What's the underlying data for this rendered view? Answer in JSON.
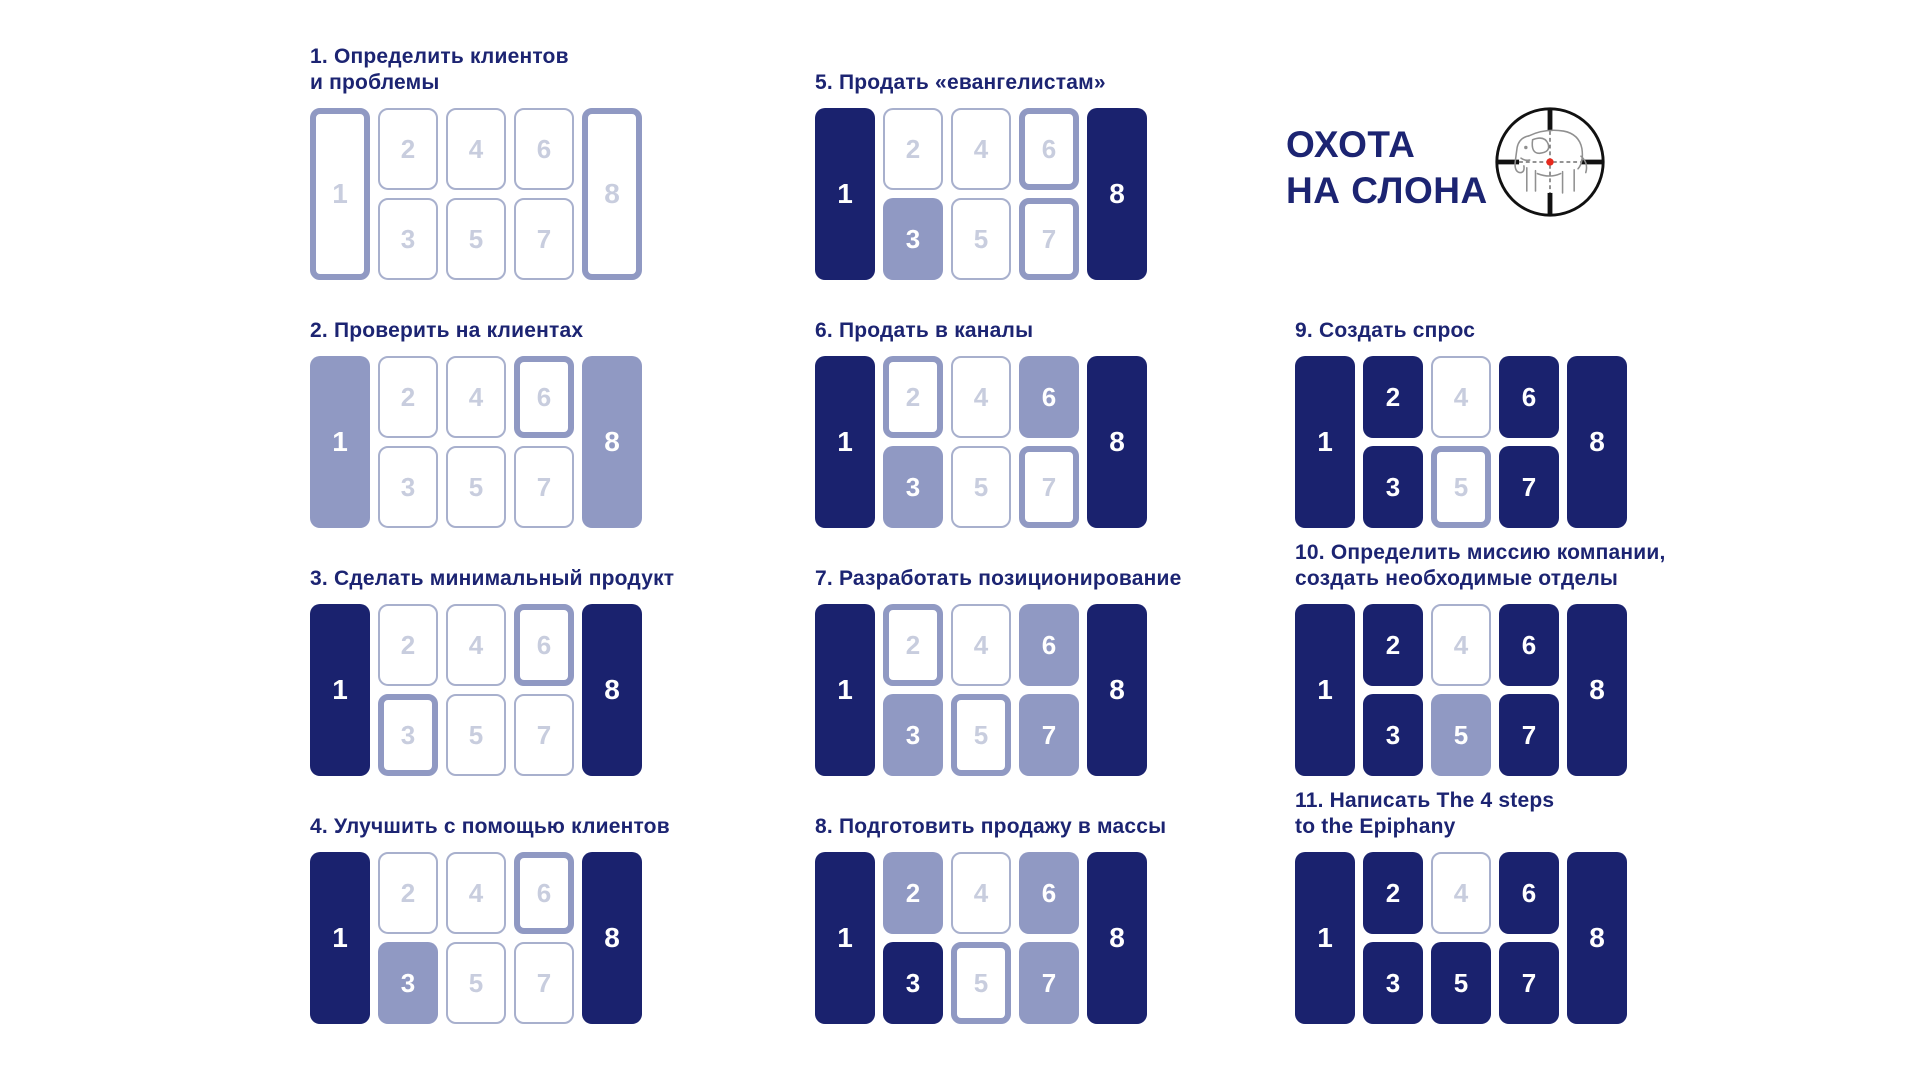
{
  "logo": {
    "title": "ОХОТА\nНА СЛОНА",
    "icon": "elephant-in-crosshair-icon"
  },
  "colors": {
    "dark_fill": "#1a226e",
    "light_fill": "#9099c3",
    "outline_border": "#a8b0cd",
    "thick_outline_border": "#9099c3",
    "muted_number": "#c8cdde",
    "title_text": "#1c2472",
    "crosshair_dot_red": "#e8291d",
    "elephant_gray": "#909090"
  },
  "steps": [
    {
      "title": "1. Определить клиентов\nи проблемы",
      "cells": {
        "c1": {
          "label": "1",
          "state": "outline-thick"
        },
        "c2": {
          "label": "2",
          "state": "outline"
        },
        "c3": {
          "label": "3",
          "state": "outline"
        },
        "c4": {
          "label": "4",
          "state": "outline"
        },
        "c5": {
          "label": "5",
          "state": "outline"
        },
        "c6": {
          "label": "6",
          "state": "outline"
        },
        "c7": {
          "label": "7",
          "state": "outline"
        },
        "c8": {
          "label": "8",
          "state": "outline-thick"
        }
      }
    },
    {
      "title": "2. Проверить на клиентах",
      "cells": {
        "c1": {
          "label": "1",
          "state": "light"
        },
        "c2": {
          "label": "2",
          "state": "outline"
        },
        "c3": {
          "label": "3",
          "state": "outline"
        },
        "c4": {
          "label": "4",
          "state": "outline"
        },
        "c5": {
          "label": "5",
          "state": "outline"
        },
        "c6": {
          "label": "6",
          "state": "outline-thick"
        },
        "c7": {
          "label": "7",
          "state": "outline"
        },
        "c8": {
          "label": "8",
          "state": "light"
        }
      }
    },
    {
      "title": "3. Сделать минимальный продукт",
      "cells": {
        "c1": {
          "label": "1",
          "state": "dark"
        },
        "c2": {
          "label": "2",
          "state": "outline"
        },
        "c3": {
          "label": "3",
          "state": "outline-thick"
        },
        "c4": {
          "label": "4",
          "state": "outline"
        },
        "c5": {
          "label": "5",
          "state": "outline"
        },
        "c6": {
          "label": "6",
          "state": "outline-thick"
        },
        "c7": {
          "label": "7",
          "state": "outline"
        },
        "c8": {
          "label": "8",
          "state": "dark"
        }
      }
    },
    {
      "title": "4. Улучшить с помощью клиентов",
      "cells": {
        "c1": {
          "label": "1",
          "state": "dark"
        },
        "c2": {
          "label": "2",
          "state": "outline"
        },
        "c3": {
          "label": "3",
          "state": "light"
        },
        "c4": {
          "label": "4",
          "state": "outline"
        },
        "c5": {
          "label": "5",
          "state": "outline"
        },
        "c6": {
          "label": "6",
          "state": "outline-thick"
        },
        "c7": {
          "label": "7",
          "state": "outline"
        },
        "c8": {
          "label": "8",
          "state": "dark"
        }
      }
    },
    {
      "title": "5. Продать «евангелистам»",
      "cells": {
        "c1": {
          "label": "1",
          "state": "dark"
        },
        "c2": {
          "label": "2",
          "state": "outline"
        },
        "c3": {
          "label": "3",
          "state": "light"
        },
        "c4": {
          "label": "4",
          "state": "outline"
        },
        "c5": {
          "label": "5",
          "state": "outline"
        },
        "c6": {
          "label": "6",
          "state": "outline-thick"
        },
        "c7": {
          "label": "7",
          "state": "outline-thick"
        },
        "c8": {
          "label": "8",
          "state": "dark"
        }
      }
    },
    {
      "title": "6. Продать в каналы",
      "cells": {
        "c1": {
          "label": "1",
          "state": "dark"
        },
        "c2": {
          "label": "2",
          "state": "outline-thick"
        },
        "c3": {
          "label": "3",
          "state": "light"
        },
        "c4": {
          "label": "4",
          "state": "outline"
        },
        "c5": {
          "label": "5",
          "state": "outline"
        },
        "c6": {
          "label": "6",
          "state": "light"
        },
        "c7": {
          "label": "7",
          "state": "outline-thick"
        },
        "c8": {
          "label": "8",
          "state": "dark"
        }
      }
    },
    {
      "title": "7. Разработать позиционирование",
      "cells": {
        "c1": {
          "label": "1",
          "state": "dark"
        },
        "c2": {
          "label": "2",
          "state": "outline-thick"
        },
        "c3": {
          "label": "3",
          "state": "light"
        },
        "c4": {
          "label": "4",
          "state": "outline"
        },
        "c5": {
          "label": "5",
          "state": "outline-thick"
        },
        "c6": {
          "label": "6",
          "state": "light"
        },
        "c7": {
          "label": "7",
          "state": "light"
        },
        "c8": {
          "label": "8",
          "state": "dark"
        }
      }
    },
    {
      "title": "8. Подготовить продажу в массы",
      "cells": {
        "c1": {
          "label": "1",
          "state": "dark"
        },
        "c2": {
          "label": "2",
          "state": "light"
        },
        "c3": {
          "label": "3",
          "state": "dark"
        },
        "c4": {
          "label": "4",
          "state": "outline"
        },
        "c5": {
          "label": "5",
          "state": "outline-thick"
        },
        "c6": {
          "label": "6",
          "state": "light"
        },
        "c7": {
          "label": "7",
          "state": "light"
        },
        "c8": {
          "label": "8",
          "state": "dark"
        }
      }
    },
    {
      "title": "9. Создать спрос",
      "cells": {
        "c1": {
          "label": "1",
          "state": "dark"
        },
        "c2": {
          "label": "2",
          "state": "dark"
        },
        "c3": {
          "label": "3",
          "state": "dark"
        },
        "c4": {
          "label": "4",
          "state": "outline"
        },
        "c5": {
          "label": "5",
          "state": "outline-thick"
        },
        "c6": {
          "label": "6",
          "state": "dark"
        },
        "c7": {
          "label": "7",
          "state": "dark"
        },
        "c8": {
          "label": "8",
          "state": "dark"
        }
      }
    },
    {
      "title": "10. Определить миссию компании,\nсоздать необходимые отделы",
      "cells": {
        "c1": {
          "label": "1",
          "state": "dark"
        },
        "c2": {
          "label": "2",
          "state": "dark"
        },
        "c3": {
          "label": "3",
          "state": "dark"
        },
        "c4": {
          "label": "4",
          "state": "outline"
        },
        "c5": {
          "label": "5",
          "state": "light"
        },
        "c6": {
          "label": "6",
          "state": "dark"
        },
        "c7": {
          "label": "7",
          "state": "dark"
        },
        "c8": {
          "label": "8",
          "state": "dark"
        }
      }
    },
    {
      "title": "11. Написать The 4 steps\nto the Epiphany",
      "cells": {
        "c1": {
          "label": "1",
          "state": "dark"
        },
        "c2": {
          "label": "2",
          "state": "dark"
        },
        "c3": {
          "label": "3",
          "state": "dark"
        },
        "c4": {
          "label": "4",
          "state": "outline"
        },
        "c5": {
          "label": "5",
          "state": "dark"
        },
        "c6": {
          "label": "6",
          "state": "dark"
        },
        "c7": {
          "label": "7",
          "state": "dark"
        },
        "c8": {
          "label": "8",
          "state": "dark"
        }
      }
    }
  ]
}
